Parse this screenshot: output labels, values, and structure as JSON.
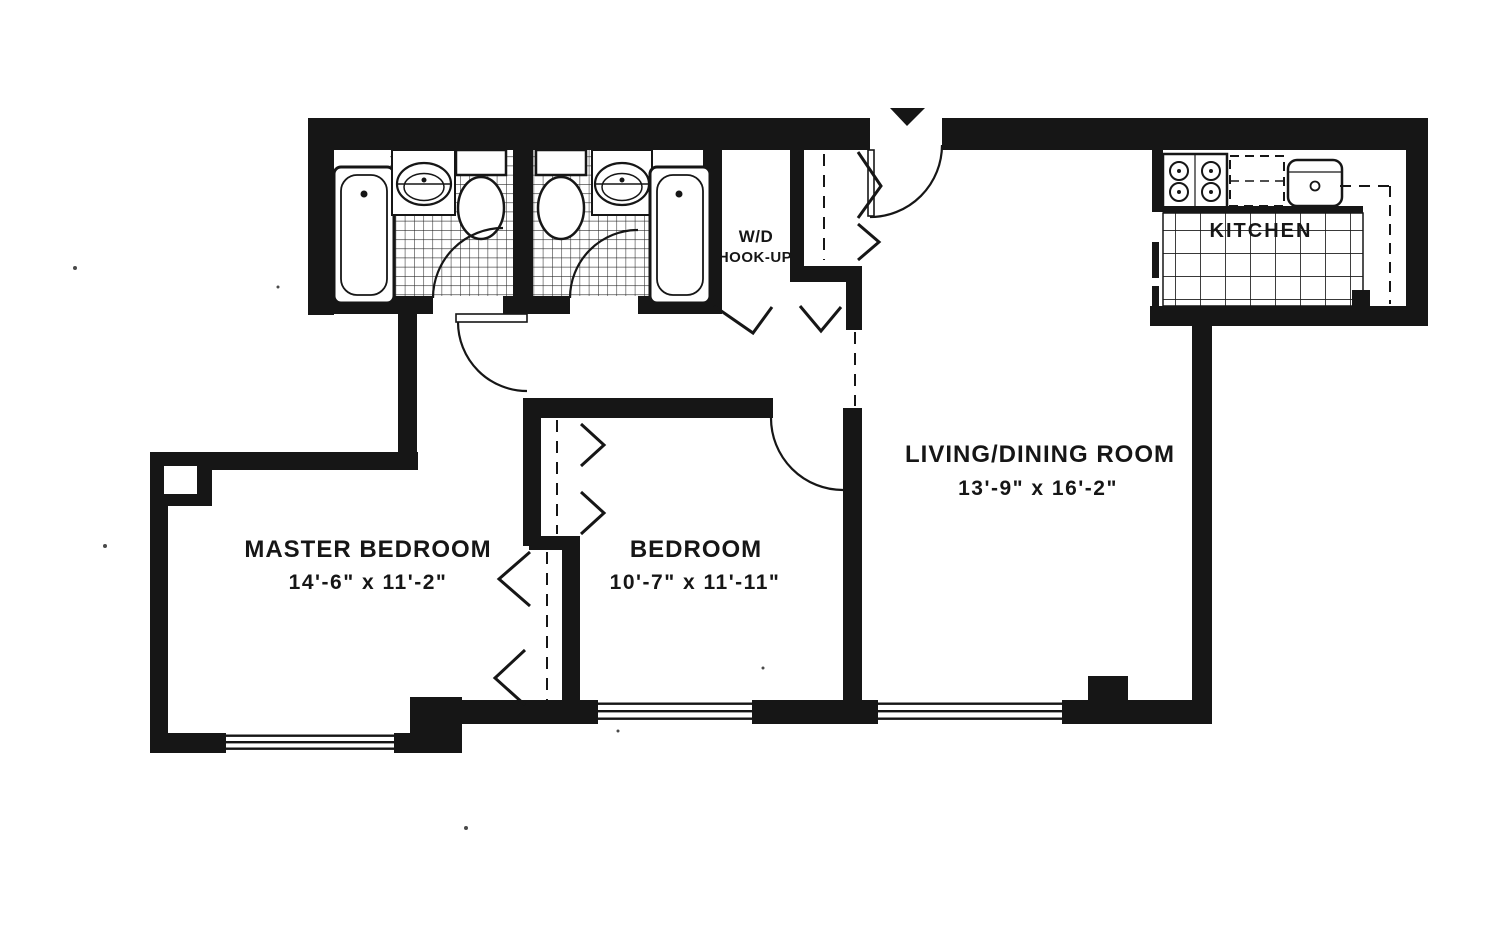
{
  "page": {
    "type": "apartment-floor-plan",
    "background_color": "#ffffff",
    "ink_color": "#161616"
  },
  "rooms": {
    "master_bedroom": {
      "name": "MASTER BEDROOM",
      "dimensions": "14'-6\" x 11'-2\""
    },
    "bedroom": {
      "name": "BEDROOM",
      "dimensions": "10'-7\" x 11'-11\""
    },
    "living_dining_room": {
      "name": "LIVING/DINING ROOM",
      "dimensions": "13'-9\" x 16'-2\""
    },
    "kitchen": {
      "name": "KITCHEN"
    },
    "laundry_closet": {
      "line1": "W/D",
      "line2": "HOOK-UP"
    }
  },
  "fixtures": {
    "bathroom_1": [
      "bathtub",
      "vanity-sink",
      "toilet"
    ],
    "bathroom_2": [
      "toilet",
      "vanity-sink",
      "bathtub"
    ],
    "kitchen": [
      "range",
      "dishwasher",
      "sink"
    ],
    "window_count": 3,
    "entry_marker": "arrow"
  }
}
